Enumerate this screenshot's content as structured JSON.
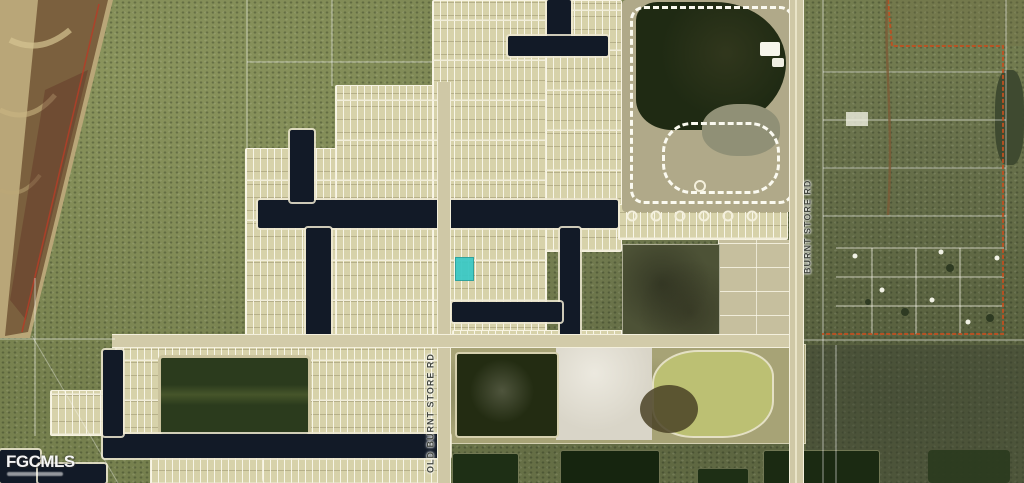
{
  "map": {
    "description": "Aerial satellite map of platted canal subdivision with subject lot highlighted",
    "watermark": {
      "text": "FGCMLS"
    },
    "road_labels": [
      {
        "id": "old-burnt-store-rd",
        "text": "OLD BURNT STORE RD"
      },
      {
        "id": "burnt-store-rd",
        "text": "BURNT STORE RD"
      }
    ],
    "marker": {
      "name": "subject-lot-highlight",
      "color": "#3CC9C5"
    },
    "colors": {
      "scrub_green": "#76804E",
      "plat_tan": "#D7D2AA",
      "street_white": "#F2EEDA",
      "canal_dark": "#121A27",
      "lake_green": "#2B3B1D",
      "mine_pond_yellow": "#BCC073",
      "boundary_orange": "#C05020",
      "shore_brown": "#6B4F30",
      "marker_teal": "#3CC9C5"
    }
  }
}
